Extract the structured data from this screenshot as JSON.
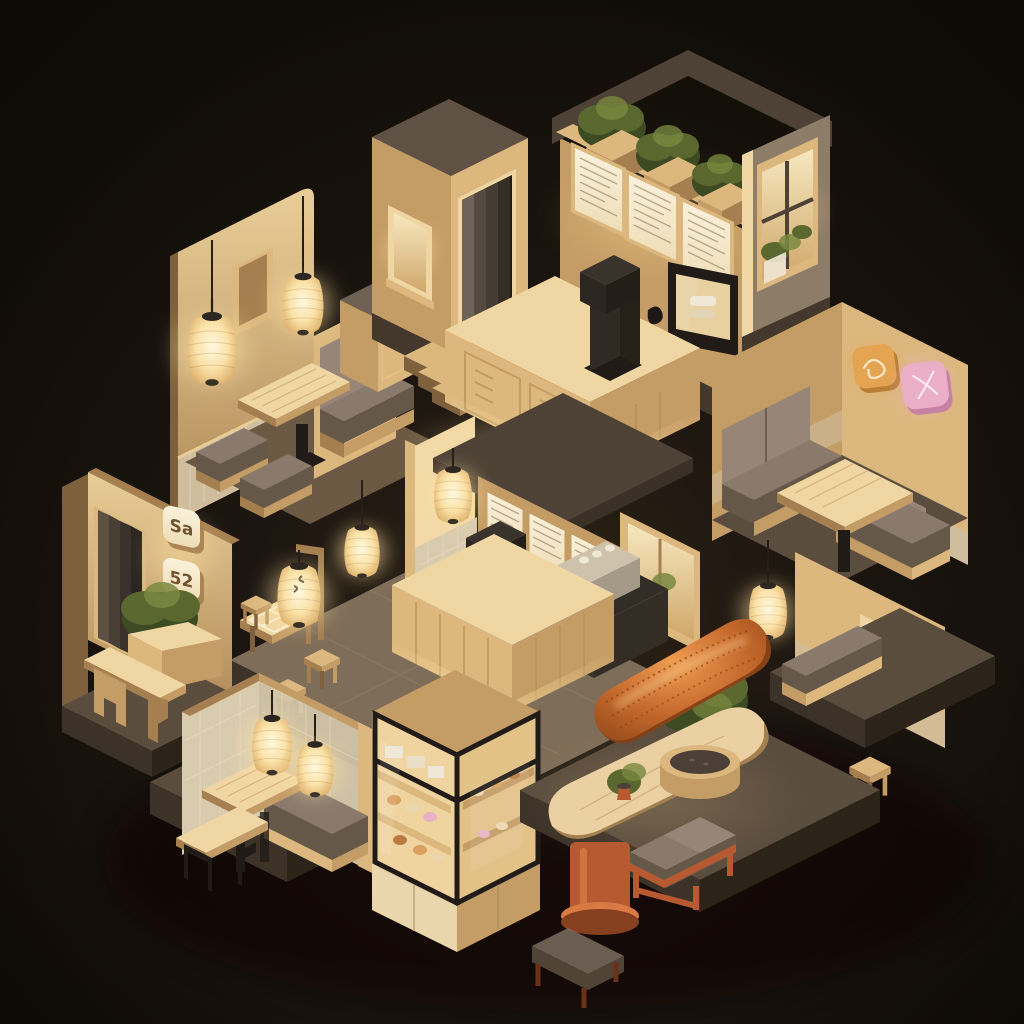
{
  "scene": {
    "type": "3d-isometric-render",
    "title": "Isometric night diorama of a Japanese café interior with paper lanterns",
    "style": "low-poly 3D render, warm lantern lighting on a dark background",
    "time_of_day": "night"
  },
  "palette": {
    "bg_deep": "#141008",
    "bg_warm": "#2b2114",
    "vignette": "#0b0805",
    "platform_top": "#5b4d3e",
    "platform_side": "#3c3228",
    "platform_dark": "#2c2319",
    "stone_floor": "#7e6d58",
    "stone_line": "#93816a",
    "wood_lit": "#f0d6a2",
    "wood_light": "#dcb87f",
    "wood_mid": "#c49c65",
    "wood_deep": "#a57f4f",
    "wood_shadow": "#7e603c",
    "panel_cream": "#f8eed7",
    "panel_line": "#8d7a57",
    "tile_wall": "#d9cbae",
    "tile_line": "#e9ddc3",
    "wainscot": "#cfbd9e",
    "roof_dark": "#4e4236",
    "skirt_dark": "#44382c",
    "wall_dim": "#8d7c67",
    "charcoal": "#332d27",
    "black_metal": "#201b16",
    "cushion": "#8a7a6c",
    "cushion_light": "#978678",
    "cushion_dark": "#665848",
    "glow": "#ffe2a2",
    "lantern_core": "#fff7dd",
    "plant": "#5a682f",
    "plant_dark": "#3d4b22",
    "plant_light": "#79883f",
    "canopy": "#c4682c",
    "canopy_light": "#ef9d52",
    "canopy_dark": "#8a4418",
    "terra": "#b85a31",
    "terra_light": "#d97a45",
    "terra_dark": "#86401f",
    "sign_pink": "#eaaec6",
    "sign_pink_dark": "#c681a3",
    "sign_orange": "#e4a452",
    "sign_orange_dark": "#b97f35",
    "glass_warm": "#d9bc8b",
    "glass_bright": "#f6e6ba",
    "steel": "#cfc2ac",
    "steel_dark": "#8f8371"
  },
  "signs": {
    "entry_sign_top": {
      "glyph": "Sa",
      "style": "glowing cream square lightbox"
    },
    "entry_sign_bottom": {
      "glyph": "52",
      "style": "glowing cream square lightbox"
    },
    "wall_plaque_orange": {
      "icon": "doodle-bowl-icon",
      "color": "#e4a452"
    },
    "wall_plaque_pink": {
      "icon": "doodle-cross-icon",
      "color": "#eaaec6"
    }
  },
  "counts": {
    "paper_lanterns": 8,
    "glowing_entry_signs": 2,
    "wall_plaques": 2,
    "menu_boards_large": 3,
    "menu_boards_small": 3,
    "rooftop_planters": 3,
    "booths": 4,
    "benches": 5,
    "stools": 4,
    "windows": 4,
    "steps": 3
  },
  "modules": [
    {
      "id": "booth-upper-left",
      "label": "Booth lounge with two paper lanterns, wall frame, table and ottomans"
    },
    {
      "id": "stair-tower",
      "label": "Entry tower with glowing window, curtained doorway and three steps"
    },
    {
      "id": "menu-kitchen",
      "label": "Open kitchen with three backlit menu boards, rooftop herb planters and paned window"
    },
    {
      "id": "service-counter",
      "label": "Front service counter with coffee grinder and chevron wood doors"
    },
    {
      "id": "center-cafe",
      "label": "Central café room with lantern, small menu boards, espresso machine and lit counter"
    },
    {
      "id": "booth-right",
      "label": "Booth room with orange and pink wall plaques and hanging lantern"
    },
    {
      "id": "window-nook-right",
      "label": "Bench nook with warm window and wooden stool"
    },
    {
      "id": "entrance-left",
      "label": "Entrance with noren curtain, two glowing signs, planter and wooden bench"
    },
    {
      "id": "patio-tables",
      "label": "Stone patio with low tray table, stools and two lanterns"
    },
    {
      "id": "booth-lower-left",
      "label": "Tiled booth with two lanterns, table and metal-leg bench"
    },
    {
      "id": "pastry-case",
      "label": "Illuminated glass pastry display case"
    },
    {
      "id": "patio-canopy",
      "label": "Woven orange canopy over oval table with bonsai and red-frame benches"
    }
  ]
}
